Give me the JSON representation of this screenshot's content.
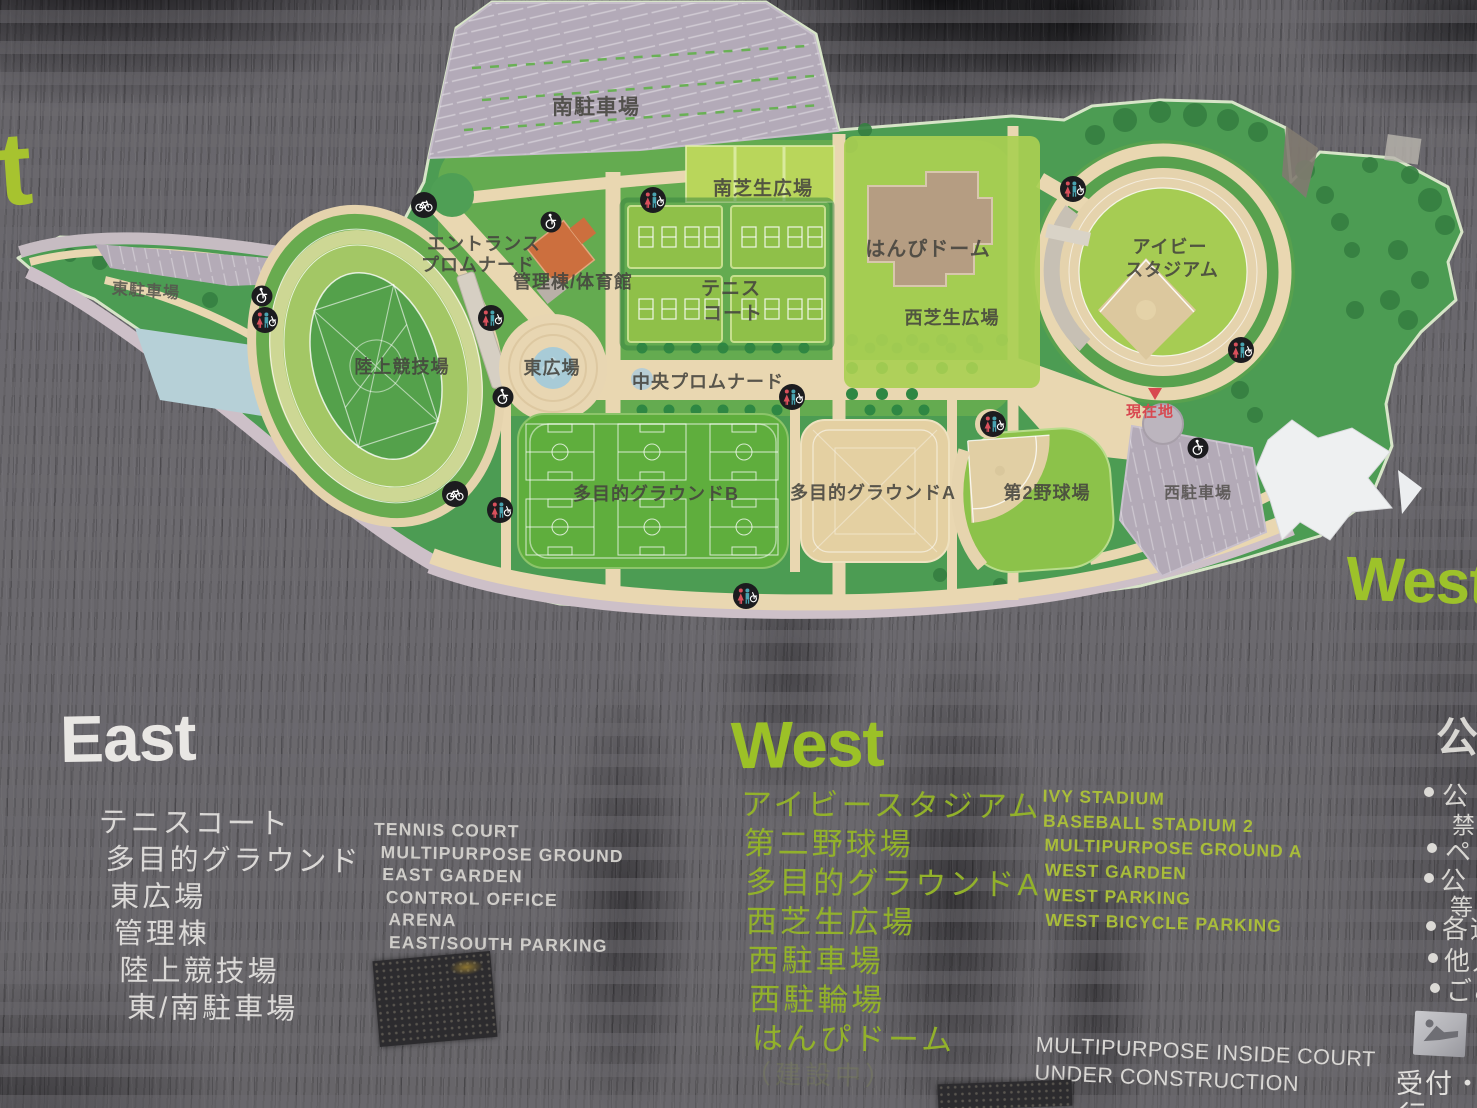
{
  "sign": {
    "partial_left_letter": "t",
    "big_west_right": "West"
  },
  "map": {
    "labels": {
      "south_parking": "南駐車場",
      "south_lawn_plaza": "南芝生広場",
      "entrance_promenade_1": "エントランス",
      "entrance_promenade_2": "プロムナード",
      "admin_gym": "管理棟/体育館",
      "tennis_1": "テニス",
      "tennis_2": "コート",
      "hanpi_dome": "はんぴドーム",
      "west_lawn_plaza": "西芝生広場",
      "ivy_stadium_1": "アイビー",
      "ivy_stadium_2": "スタジアム",
      "east_parking": "東駐車場",
      "athletics_field": "陸上競技場",
      "east_plaza": "東広場",
      "central_promenade": "中央プロムナード",
      "multipurpose_b": "多目的グラウンドB",
      "multipurpose_a": "多目的グラウンドA",
      "baseball_field_2": "第2野球場",
      "west_parking": "西駐車場",
      "current_location": "現在地"
    },
    "icons": [
      "toilet-icon",
      "wheelchair-icon",
      "bicycle-icon"
    ]
  },
  "legend_east": {
    "title": "East",
    "items_ja": [
      "テニスコート",
      "多目的グラウンド",
      "東広場",
      "管理棟",
      "陸上競技場",
      "東/南駐車場"
    ],
    "items_en": [
      "TENNIS COURT",
      "MULTIPURPOSE GROUND",
      "EAST GARDEN",
      "CONTROL OFFICE",
      "ARENA",
      "EAST/SOUTH PARKING"
    ]
  },
  "legend_west": {
    "title": "West",
    "items_ja": [
      "アイビースタジアム",
      "第二野球場",
      "多目的グラウンドA",
      "西芝生広場",
      "西駐車場",
      "西駐輪場",
      "はんぴドーム"
    ],
    "items_en": [
      "IVY STADIUM",
      "BASEBALL STADIUM 2",
      "MULTIPURPOSE GROUND A",
      "WEST GARDEN",
      "WEST PARKING",
      "WEST BICYCLE PARKING"
    ]
  },
  "construction_note": {
    "line1": "MULTIPURPOSE INSIDE COURT",
    "line2": "UNDER CONSTRUCTION",
    "faint_ja": "（建設中）"
  },
  "rules_column": {
    "heading": "公",
    "b1": "公",
    "b1_sub": "禁",
    "b2": "ペ",
    "b3": "公",
    "b3_sub": "等の",
    "b4": "各遊",
    "b5": "他人",
    "b6": "ごみ",
    "reception_1": "受付・",
    "reception_2": "行"
  },
  "colors": {
    "wall_gray": "#6b696e",
    "park_green": "#4c9c53",
    "path_tan": "#e9d7b1",
    "parking_gray": "#b4abb7",
    "lawn_light": "#b9d65b",
    "field_green": "#5fae3d",
    "sand_ground": "#e4d0a2",
    "dome_brown": "#b59d82",
    "admin_orange": "#cc6f3e",
    "pond_blue": "#a8cbd7",
    "accent_green": "#9cc127",
    "legend_white": "#e9e7e4",
    "current_location_red": "#d84850"
  }
}
